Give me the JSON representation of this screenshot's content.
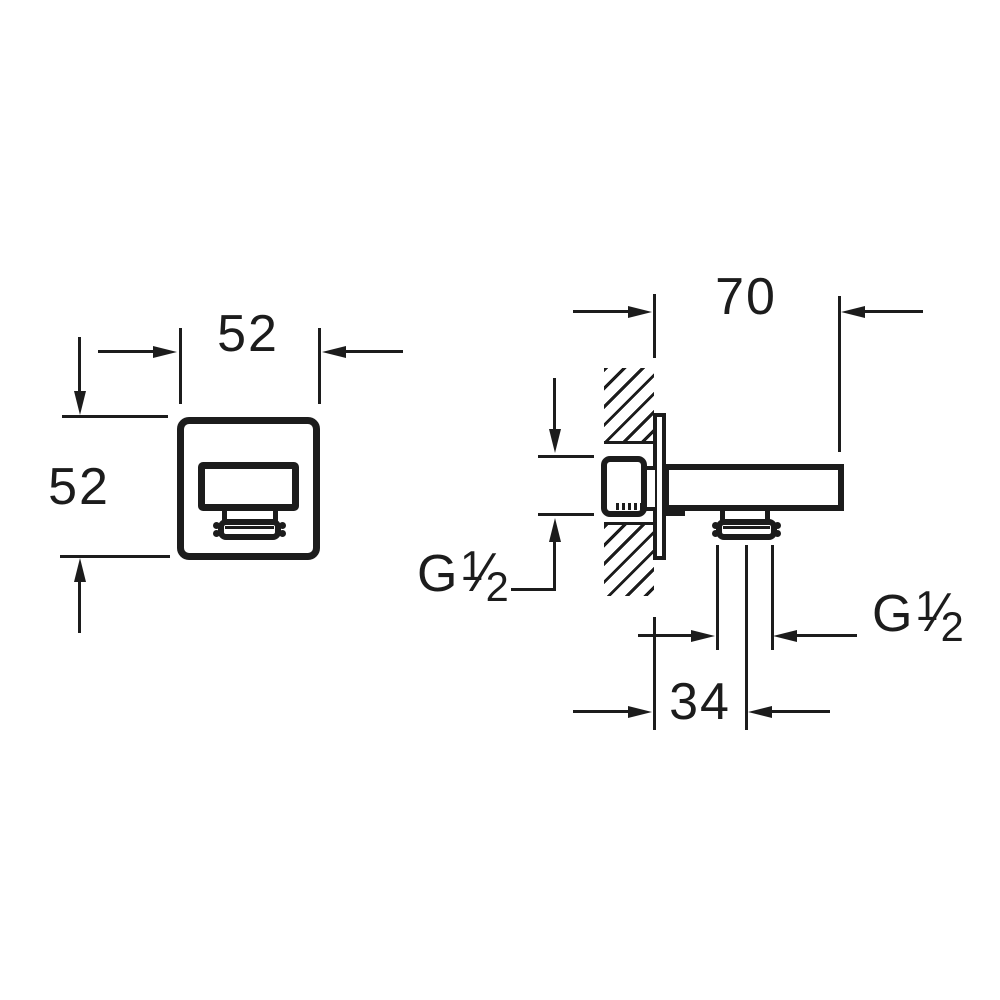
{
  "page": {
    "background": "#ffffff",
    "line_color": "#1c1c1c"
  },
  "drawing": {
    "type": "technical-dimension-drawing",
    "front_view": {
      "width": "52",
      "height": "52"
    },
    "side_view": {
      "spout_length": "70",
      "outlet_offset": "34",
      "inlet_thread": {
        "prefix": "G",
        "numerator": "1",
        "slash": "⁄",
        "denominator": "2"
      },
      "outlet_thread": {
        "prefix": "G",
        "numerator": "1",
        "slash": "⁄",
        "denominator": "2"
      }
    }
  }
}
